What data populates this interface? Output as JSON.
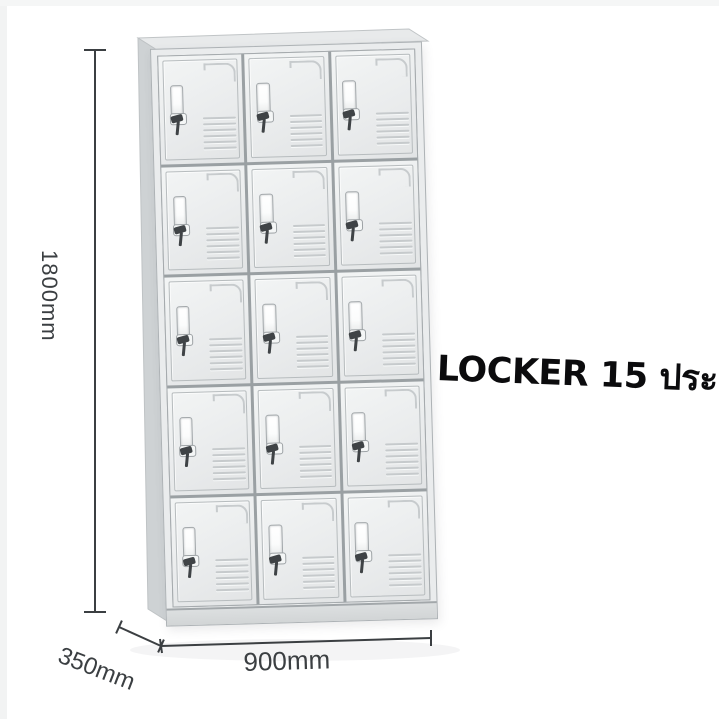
{
  "product": {
    "title": "LOCKER 15 ประตู"
  },
  "dimensions": {
    "height": {
      "label": "1800mm"
    },
    "depth": {
      "label": "350mm"
    },
    "width": {
      "label": "900mm"
    }
  },
  "locker": {
    "rows": 5,
    "columns": 3,
    "door_count": 15,
    "colors": {
      "door_face": "#eaeced",
      "door_gap": "#9aa0a3",
      "side_panel": "#ced2d4",
      "top_panel": "#e8eaeb",
      "base": "#dcdfe0",
      "handle": "#fbfcfc",
      "key": "#3f4346",
      "dimension_line": "#3b3f42",
      "text": "#0b0b0d"
    }
  }
}
